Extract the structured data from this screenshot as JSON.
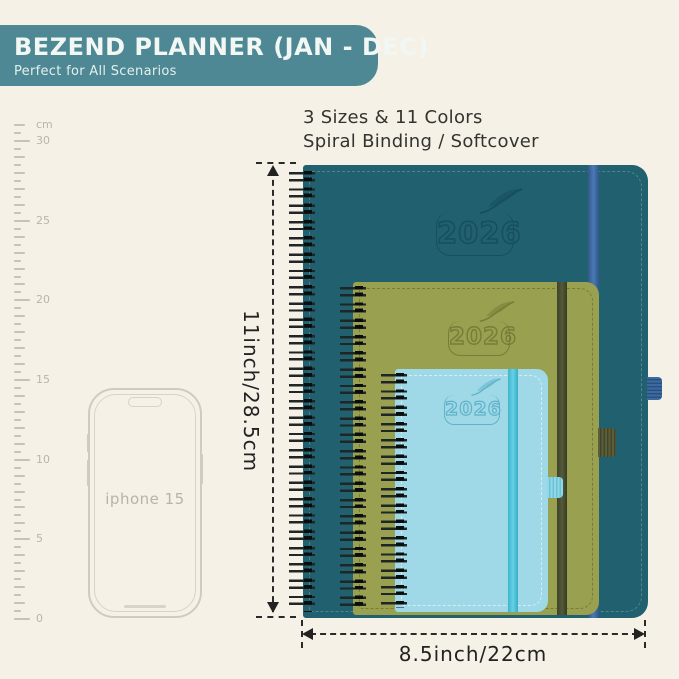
{
  "background_color": "#f5f1e7",
  "banner": {
    "title": "BEZEND PLANNER (JAN - DEC)",
    "subtitle": "Perfect for All Scenarios",
    "color": "#4d8894"
  },
  "features": {
    "line1": "3 Sizes & 11 Colors",
    "line2": "Spiral Binding / Softcover"
  },
  "ruler": {
    "unit": "cm",
    "major_labels": [
      "30",
      "25",
      "20",
      "15",
      "10",
      "5",
      "0"
    ]
  },
  "phone": {
    "label": "iphone 15"
  },
  "planners": [
    {
      "name": "large-planner",
      "year": "2026",
      "cover_color": "#20606f",
      "band_color": "#3e6ea6"
    },
    {
      "name": "medium-planner",
      "year": "2026",
      "cover_color": "#99a04f",
      "band_color": "#4a4e33"
    },
    {
      "name": "small-planner",
      "year": "2026",
      "cover_color": "#9fd9e8",
      "band_color": "#4cc3da"
    }
  ],
  "dimensions": {
    "height_label": "11inch/28.5cm",
    "width_label": "8.5inch/22cm"
  }
}
